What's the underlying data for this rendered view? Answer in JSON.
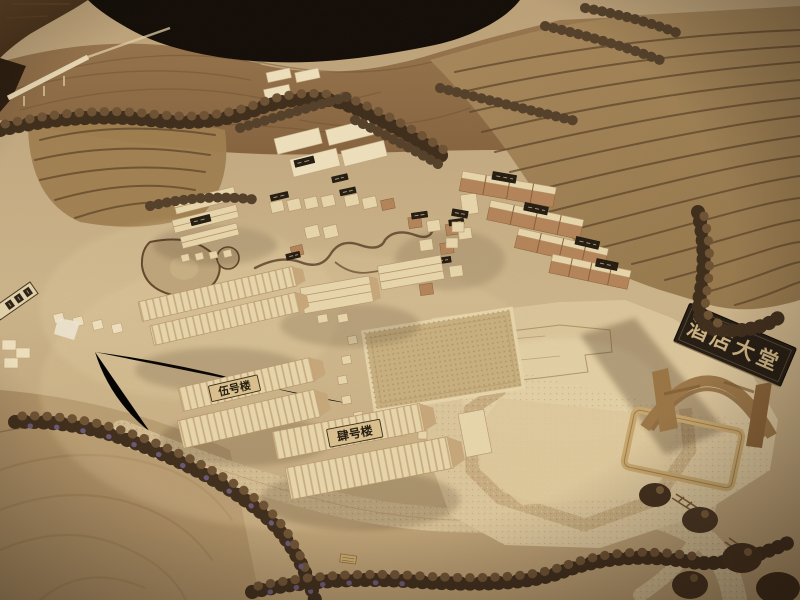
{
  "scene": {
    "description": "Photograph of a wooden architectural scale model of a hillside resort village with terraced slopes, tree rows, building clusters and a hotel site",
    "signs": {
      "hotel_lobby": "酒店大堂",
      "building_no5": "伍号楼",
      "building_no4": "肆号楼"
    },
    "colors": {
      "background_dark": "#120c07",
      "table_wood": "#5f4226",
      "hill_brown": "#8a6745",
      "terrace_line": "#5e442a",
      "ground_sand": "#c7ae87",
      "plywood_pad": "#dcc69c",
      "building_light_wood": "#e9d7ae",
      "building_cork": "#b5855a",
      "tree_dark": "#3f2d1c",
      "tree_purple": "#6a5878",
      "sign_board": "#241c13",
      "sign_text": "#cfb383",
      "plaque_tan": "#dbc28f",
      "plaque_text": "#241c12"
    }
  }
}
